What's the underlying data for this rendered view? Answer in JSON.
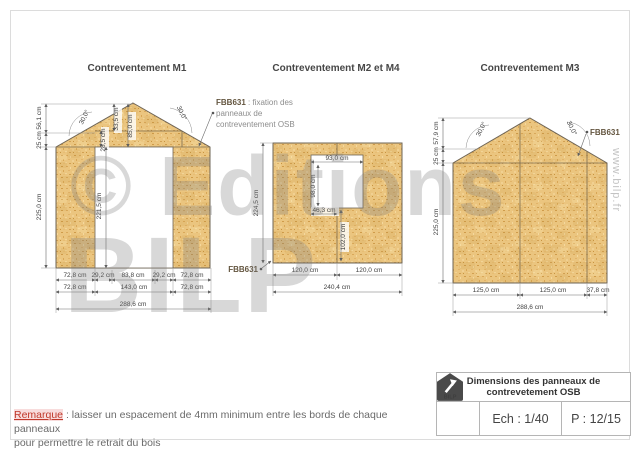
{
  "watermark": {
    "line1": "© Editions",
    "line2": "BILP",
    "side": "www.bilp.fr"
  },
  "m1": {
    "title": "Contreventement M1",
    "angle_left": "30,0°",
    "angle_right": "30,0°",
    "dim_upper_left": "56,1 cm",
    "dim_lower_left": "25 cm",
    "dim_height": "225,0 cm",
    "dim_apex_a": "33,5 cm",
    "dim_apex_b": "85,0 cm",
    "dim_above_door": "28,5 cm",
    "dim_door_height": "221,5 cm",
    "row1": [
      "72,8 cm",
      "29,2 cm",
      "83,8 cm",
      "29,2 cm",
      "72,8 cm"
    ],
    "row2": [
      "72,8 cm",
      "143,0 cm",
      "72,8 cm"
    ],
    "total": "288,6 cm"
  },
  "m2": {
    "title": "Contreventement M2 et M4",
    "ann_code": "FBB631",
    "ann_rest": " : fixation des",
    "ann_line2": "panneaux de",
    "ann_line3": "contreventement OSB",
    "fbb": "FBB631",
    "dim_height": "224,5 cm",
    "win_w": "93,0 cm",
    "win_h": "98,0 cm",
    "win_off": "46,3 cm",
    "below_win": "102,0 cm",
    "row1": [
      "120,0 cm",
      "120,0 cm"
    ],
    "total": "240,4 cm"
  },
  "m3": {
    "title": "Contreventement M3",
    "fbb": "FBB631",
    "angle_left": "30,0°",
    "angle_right": "30,0°",
    "dim_upper_left": "57,9 cm",
    "dim_lower_left": "25 cm",
    "dim_height": "225,0 cm",
    "row1": [
      "125,0 cm",
      "125,0 cm",
      "37,8 cm"
    ],
    "total": "288,6 cm"
  },
  "remark": {
    "label": "Remarque",
    "line1": " : laisser un espacement de 4mm minimum entre les bords de chaque panneaux",
    "line2": "pour permettre le retrait du bois"
  },
  "titleblock": {
    "line1": "Dimensions des panneaux de",
    "line2": "contrevetement OSB",
    "scale": "Ech : 1/40",
    "page": "P : 12/15",
    "logo": "BILP"
  },
  "colors": {
    "osb": "#ebc57f",
    "line": "#6e6455",
    "dim": "#4a4a4a",
    "red": "#c0392b"
  }
}
